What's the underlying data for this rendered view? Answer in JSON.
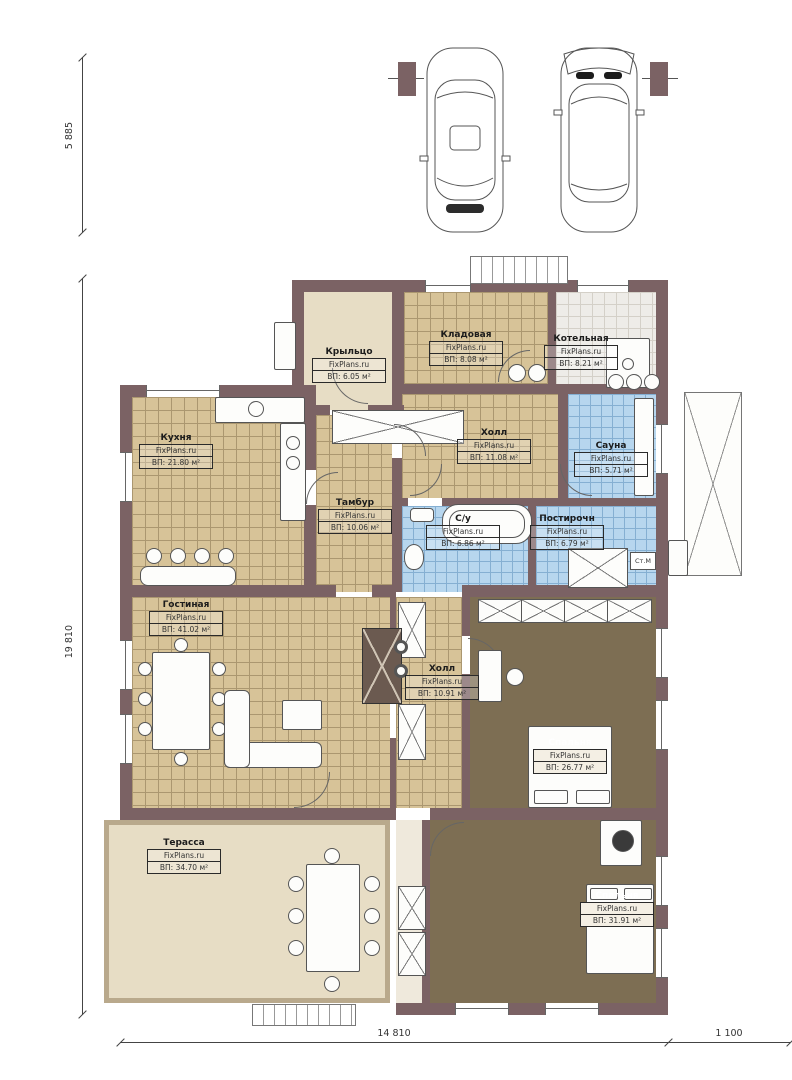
{
  "plan": {
    "watermark": "FixPlans.ru",
    "dimensions": {
      "garage_height": "5 885",
      "main_height": "19 810",
      "main_width": "14 810",
      "right_width": "1 100"
    },
    "annotations": {
      "washing_machine": "Ст.М"
    },
    "colors": {
      "wall": "#7b6264",
      "tile_tan": "#d7c398",
      "tile_tan_line": "#ab9770",
      "tile_blue": "#b7d6ee",
      "tile_blue_line": "#85afd2",
      "tile_gray": "#eeece8",
      "tile_gray_line": "#d4d0c8",
      "floor_plain": "#e7ddc5",
      "floor_dark": "#7d6e53"
    },
    "rooms": [
      {
        "id": "porch",
        "name": "Крыльцо",
        "area": "ВП: 6.05 м²"
      },
      {
        "id": "storage",
        "name": "Кладовая",
        "area": "ВП: 8.08 м²"
      },
      {
        "id": "boiler",
        "name": "Котельная",
        "area": "ВП: 8.21 м²"
      },
      {
        "id": "kitchen",
        "name": "Кухня",
        "area": "ВП: 21.80 м²"
      },
      {
        "id": "hall-top",
        "name": "Холл",
        "area": "ВП: 11.08 м²"
      },
      {
        "id": "sauna",
        "name": "Сауна",
        "area": "ВП: 5.71 м²"
      },
      {
        "id": "vestibule",
        "name": "Тамбур",
        "area": "ВП: 10.06 м²"
      },
      {
        "id": "bathroom",
        "name": "С/у",
        "area": "ВП: 6.86 м²"
      },
      {
        "id": "laundry",
        "name": "Постирочн",
        "area": "ВП: 6.79 м²"
      },
      {
        "id": "living",
        "name": "Гостиная",
        "area": "ВП: 41.02 м²"
      },
      {
        "id": "hall-mid",
        "name": "Холл",
        "area": "ВП: 10.91 м²"
      },
      {
        "id": "bedroom-1",
        "name": "Спальня",
        "area": "ВП: 26.77 м²"
      },
      {
        "id": "terrace",
        "name": "Терасса",
        "area": "ВП: 34.70 м²"
      },
      {
        "id": "bedroom-2",
        "name": "Спальня",
        "area": "ВП: 31.91 м²"
      }
    ]
  }
}
